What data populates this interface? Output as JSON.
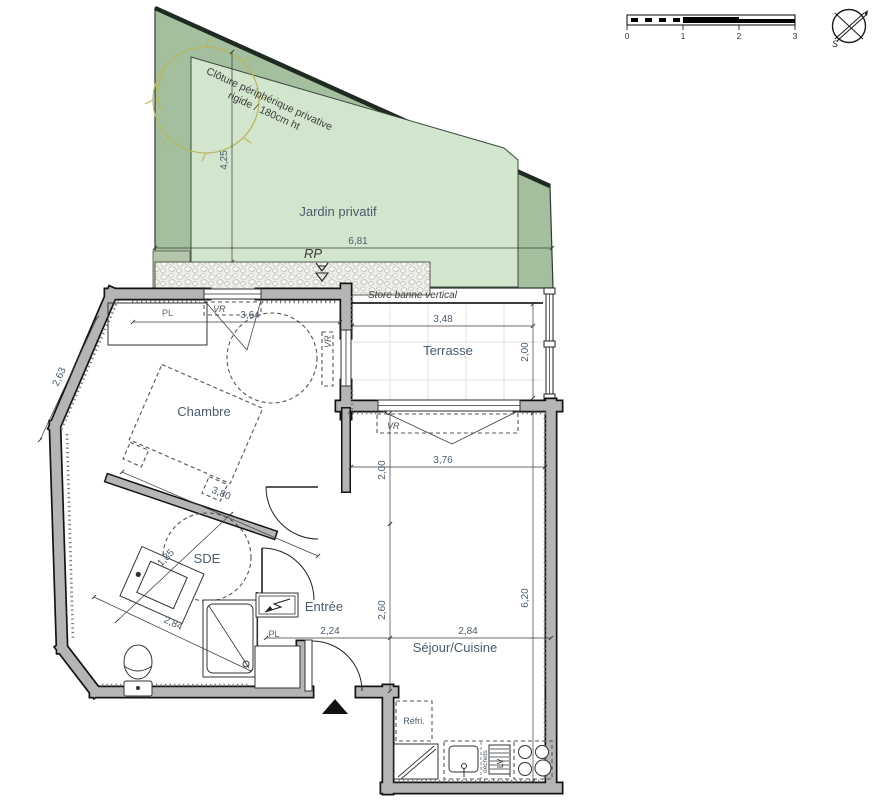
{
  "garden": {
    "label": "Jardin privatif",
    "fence_note_line1": "Clôture périphérique privative",
    "fence_note_line2": "rigide / 180cm ht",
    "rp_label": "RP",
    "width_dim": "6,81",
    "height_dim": "4,25",
    "fill_outer": "#a3bf9d",
    "fill_inner": "#d2e5cd"
  },
  "terrace": {
    "label": "Terrasse",
    "store_note": "Store banne vertical",
    "width_dim": "3,48",
    "depth_dim": "2,00",
    "window_vr_label": "VR"
  },
  "bedroom": {
    "label": "Chambre",
    "window_dim": "3,64",
    "wall_dim": "2,63",
    "diag_dim": "3,80",
    "closet_label": "PL",
    "window_vr_label": "VR"
  },
  "bathroom": {
    "label": "SDE",
    "dim_a": "1,85",
    "dim_b": "2,84"
  },
  "entry": {
    "label": "Entrée",
    "closet_label": "PL",
    "width_dim": "2,24",
    "depth_dim": "2,60"
  },
  "living": {
    "label": "Séjour/Cuisine",
    "width_top_dim": "3,76",
    "width_bottom_dim": "2,84",
    "height_dim": "6,20",
    "depth_top_dim": "2,00",
    "window_vr_label": "VR",
    "fridge_label": "Réfri.",
    "dishwasher_label": "LV",
    "waste_label": "déchets"
  },
  "scale_bar": {
    "ticks": [
      "0",
      "1",
      "2",
      "3"
    ]
  },
  "compass": {
    "south_label": "S"
  },
  "colors": {
    "wall_fill": "#b5b5b5",
    "wall_edge": "#141414",
    "label_blue": "#4a5c6e",
    "tree_olive": "#b9b55f"
  }
}
